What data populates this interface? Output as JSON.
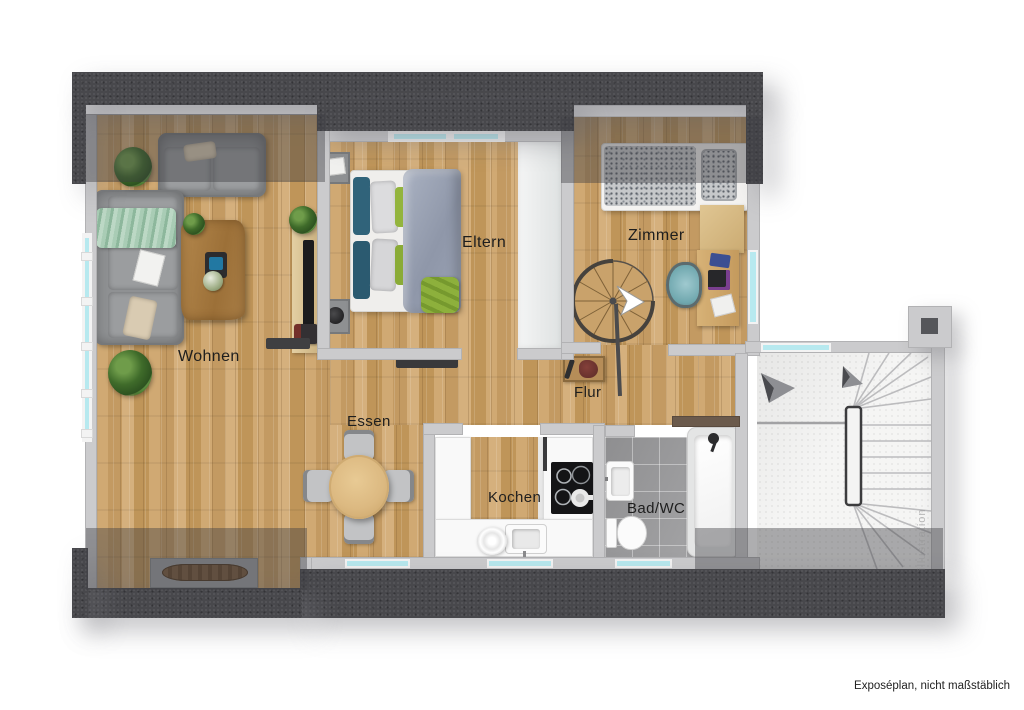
{
  "meta": {
    "type": "floor-plan",
    "footer": "Exposéplan, nicht maßstäblich",
    "watermark": "illustration"
  },
  "rooms": {
    "living": {
      "label": "Wohnen"
    },
    "parents": {
      "label": "Eltern"
    },
    "child": {
      "label": "Zimmer"
    },
    "hall": {
      "label": "Flur"
    },
    "dining": {
      "label": "Essen"
    },
    "kitchen": {
      "label": "Kochen"
    },
    "bath": {
      "label": "Bad/WC"
    }
  },
  "colors": {
    "roof": "#48484c",
    "wall": "#cbcbcd",
    "wood": "#c9a26b",
    "window": "#b7e9ef",
    "tile": "#a2a2a4",
    "accent_green": "#93b43d",
    "accent_teal": "#30637a",
    "duvet_gray": "#9aa2b4"
  }
}
